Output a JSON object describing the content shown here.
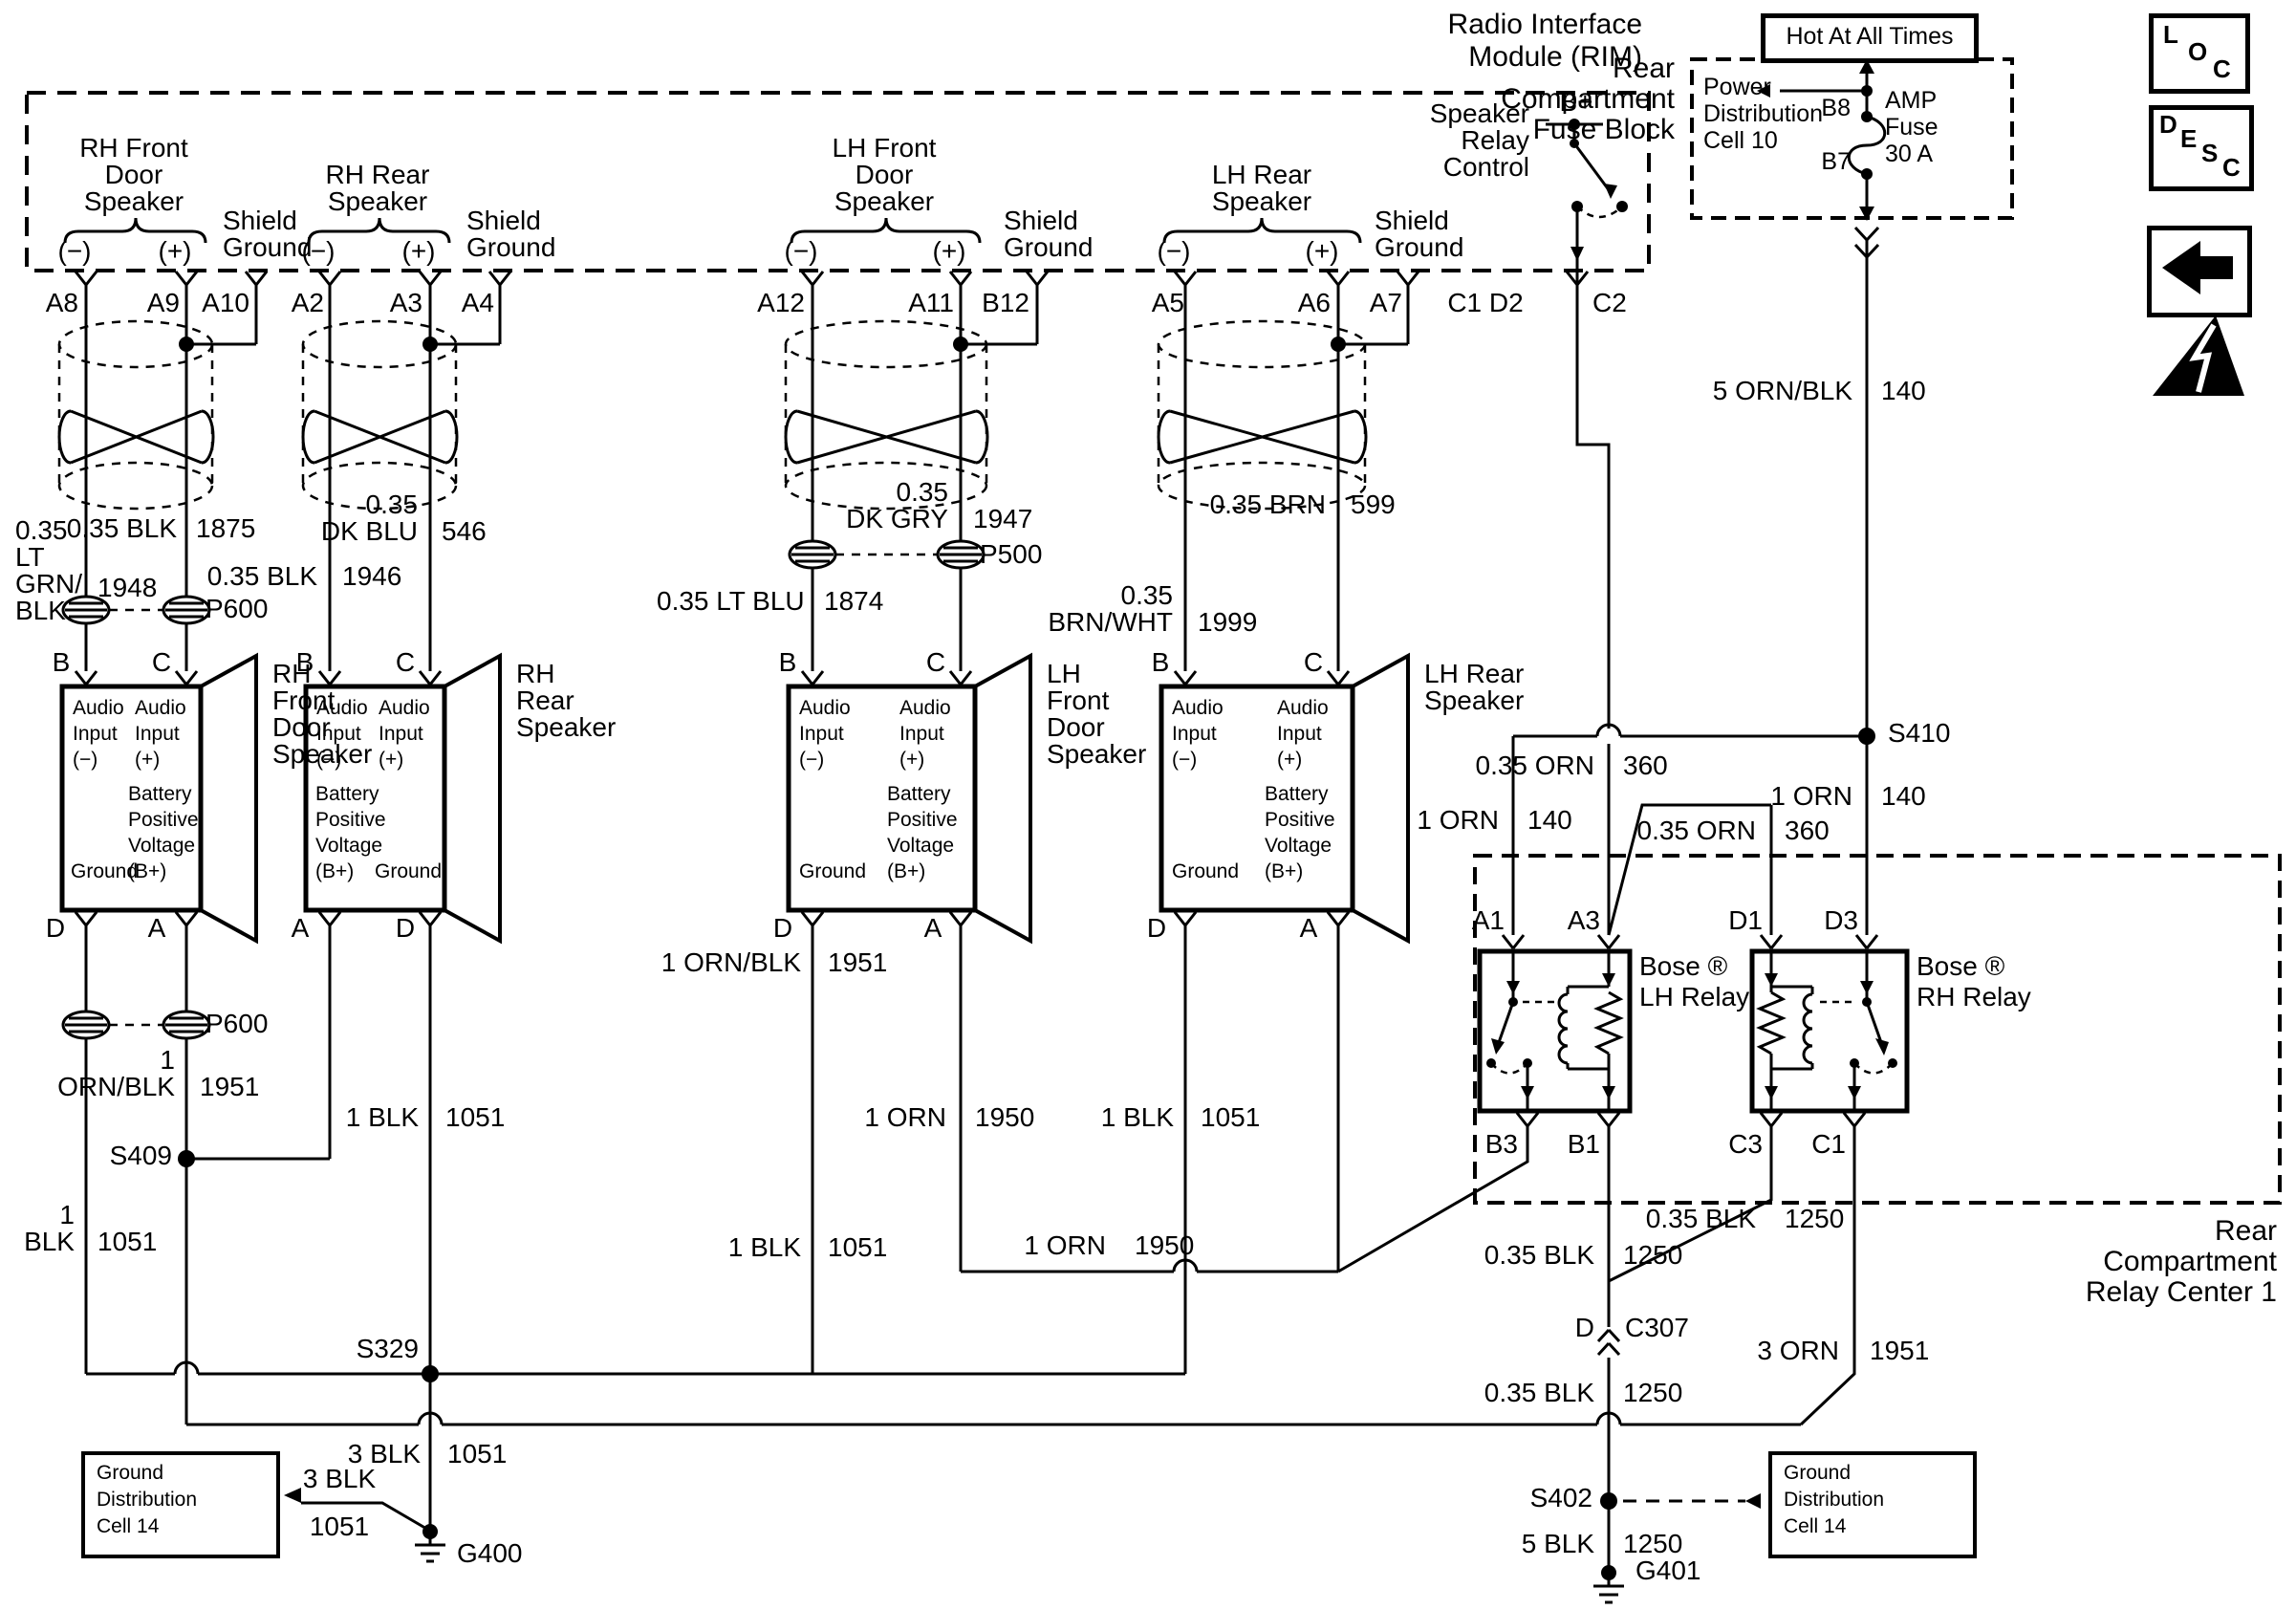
{
  "titles": {
    "rim1": "Radio Interface",
    "rim2": "Module (RIM)",
    "fuse1": "Rear",
    "fuse2": "Compartment",
    "fuse3": "Fuse Block",
    "hot": "Hot At All Times",
    "rc1": "Rear",
    "rc2": "Compartment",
    "rc3": "Relay Center 1"
  },
  "fuse_block": {
    "power1": "Power",
    "power2": "Distribution",
    "power3": "Cell 10",
    "b8": "B8",
    "b7": "B7",
    "amp1": "AMP",
    "amp2": "Fuse",
    "amp3": "30 A"
  },
  "side_icons": {
    "loc": [
      "L",
      "O",
      "C"
    ],
    "desc": [
      "D",
      "E",
      "S",
      "C"
    ]
  },
  "rim": {
    "relay_control": [
      "Speaker",
      "Relay",
      "Control"
    ],
    "bplus": "B+",
    "pins": {
      "a8": "A8",
      "a9": "A9",
      "a10": "A10",
      "a2": "A2",
      "a3": "A3",
      "a4": "A4",
      "a12": "A12",
      "a11": "A11",
      "b12": "B12",
      "a5": "A5",
      "a6": "A6",
      "a7": "A7",
      "c1d2": "C1 D2",
      "c2": "C2"
    }
  },
  "channels": [
    {
      "name": [
        "RH Front",
        "Door",
        "Speaker"
      ],
      "minus": "(−)",
      "plus": "(+)",
      "shield": [
        "Shield",
        "Ground"
      ]
    },
    {
      "name": [
        "RH Rear",
        "Speaker"
      ],
      "minus": "(−)",
      "plus": "(+)",
      "shield": [
        "Shield",
        "Ground"
      ]
    },
    {
      "name": [
        "LH Front",
        "Door",
        "Speaker"
      ],
      "minus": "(−)",
      "plus": "(+)",
      "shield": [
        "Shield",
        "Ground"
      ]
    },
    {
      "name": [
        "LH Rear",
        "Speaker"
      ],
      "minus": "(−)",
      "plus": "(+)",
      "shield": [
        "Shield",
        "Ground"
      ]
    }
  ],
  "speakers": [
    {
      "name": [
        "RH",
        "Front",
        "Door",
        "Speaker"
      ],
      "tl_pin": "B",
      "tr_pin": "C",
      "bl_pin": "D",
      "br_pin": "A",
      "tl": [
        "Audio",
        "Input",
        "(−)"
      ],
      "tr": [
        "Audio",
        "Input",
        "(+)"
      ],
      "batt": [
        "Battery",
        "Positive",
        "Voltage",
        "(B+)"
      ],
      "gnd": "Ground"
    },
    {
      "name": [
        "RH",
        "Rear",
        "Speaker"
      ],
      "tl_pin": "B",
      "tr_pin": "C",
      "bl_pin": "A",
      "br_pin": "D",
      "tl": [
        "Audio",
        "Input",
        "(−)"
      ],
      "tr": [
        "Audio",
        "Input",
        "(+)"
      ],
      "batt": [
        "Battery",
        "Positive",
        "Voltage",
        "(B+)"
      ],
      "gnd": "Ground"
    },
    {
      "name": [
        "LH",
        "Front",
        "Door",
        "Speaker"
      ],
      "tl_pin": "B",
      "tr_pin": "C",
      "bl_pin": "D",
      "br_pin": "A",
      "tl": [
        "Audio",
        "Input",
        "(−)"
      ],
      "tr": [
        "Audio",
        "Input",
        "(+)"
      ],
      "batt": [
        "Battery",
        "Positive",
        "Voltage",
        "(B+)"
      ],
      "gnd": "Ground"
    },
    {
      "name": [
        "LH Rear",
        "Speaker"
      ],
      "tl_pin": "B",
      "tr_pin": "C",
      "bl_pin": "D",
      "br_pin": "A",
      "tl": [
        "Audio",
        "Input",
        "(−)"
      ],
      "tr": [
        "Audio",
        "Input",
        "(+)"
      ],
      "batt": [
        "Battery",
        "Positive",
        "Voltage",
        "(B+)"
      ],
      "gnd": "Ground"
    }
  ],
  "relays": {
    "lh": {
      "name1": "Bose ®",
      "name2": "LH Relay",
      "a1": "A1",
      "a3": "A3",
      "b3": "B3",
      "b1": "B1"
    },
    "rh": {
      "name1": "Bose ®",
      "name2": "RH Relay",
      "d1": "D1",
      "d3": "D3",
      "c3": "C3",
      "c1": "C1"
    }
  },
  "wires": {
    "w1948a": "0.35",
    "w1948b": "LT",
    "w1948c": "GRN/",
    "w1948d": "BLK",
    "w1948n": "1948",
    "w1875": "0.35 BLK",
    "w1875n": "1875",
    "w1946": "0.35 BLK",
    "w1946n": "1946",
    "w546a": "0.35",
    "w546b": "DK BLU",
    "w546n": "546",
    "w1874": "0.35 LT BLU",
    "w1874n": "1874",
    "w1947a": "0.35",
    "w1947b": "DK GRY",
    "w1947n": "1947",
    "w1999a": "0.35",
    "w1999b": "BRN/WHT",
    "w1999n": "1999",
    "w599": "0.35 BRN",
    "w599n": "599",
    "w140f": "5 ORN/BLK",
    "w140fn": "140",
    "w360a": "0.35 ORN",
    "w360an": "360",
    "w360b": "0.35 ORN",
    "w360bn": "360",
    "w140a": "1 ORN",
    "w140an": "140",
    "w140d": "1 ORN",
    "w140dn": "140",
    "w1951h": "1 ORN/BLK",
    "w1951hn": "1951",
    "w1951va": "1",
    "w1951vb": "ORN/BLK",
    "w1951vn": "1951",
    "w1950a": "1 ORN",
    "w1950an": "1950",
    "w1950b": "1 ORN",
    "w1950bn": "1950",
    "w1051a1": "1",
    "w1051a2": "BLK",
    "w1051an": "1051",
    "w1051b": "1 BLK",
    "w1051bn": "1051",
    "w1051c": "1 BLK",
    "w1051cn": "1051",
    "w1051d": "1 BLK",
    "w1051dn": "1051",
    "w1051s": "3 BLK",
    "w1051sn": "1051",
    "w1051g1": "3 BLK",
    "w1051g2": "1051",
    "w1250c3": "0.35 BLK",
    "w1250c3n": "1250",
    "w1250b1": "0.35 BLK",
    "w1250b1n": "1250",
    "w1250c": "0.35 BLK",
    "w1250cn": "1250",
    "w1951c1": "3 ORN",
    "w1951c1n": "1951",
    "w1250g": "5 BLK",
    "w1250gn": "1250"
  },
  "splices": {
    "s409": "S409",
    "s410": "S410",
    "s329": "S329",
    "s402": "S402"
  },
  "grounds": {
    "g400": "G400",
    "g401": "G401"
  },
  "connectors": {
    "p600a": "P600",
    "p500": "P500",
    "p600b": "P600",
    "c307d": "D",
    "c307": "C307"
  },
  "ground_boxes": {
    "b1": [
      "Ground",
      "Distribution",
      "Cell 14"
    ],
    "b2": [
      "Ground",
      "Distribution",
      "Cell 14"
    ]
  }
}
